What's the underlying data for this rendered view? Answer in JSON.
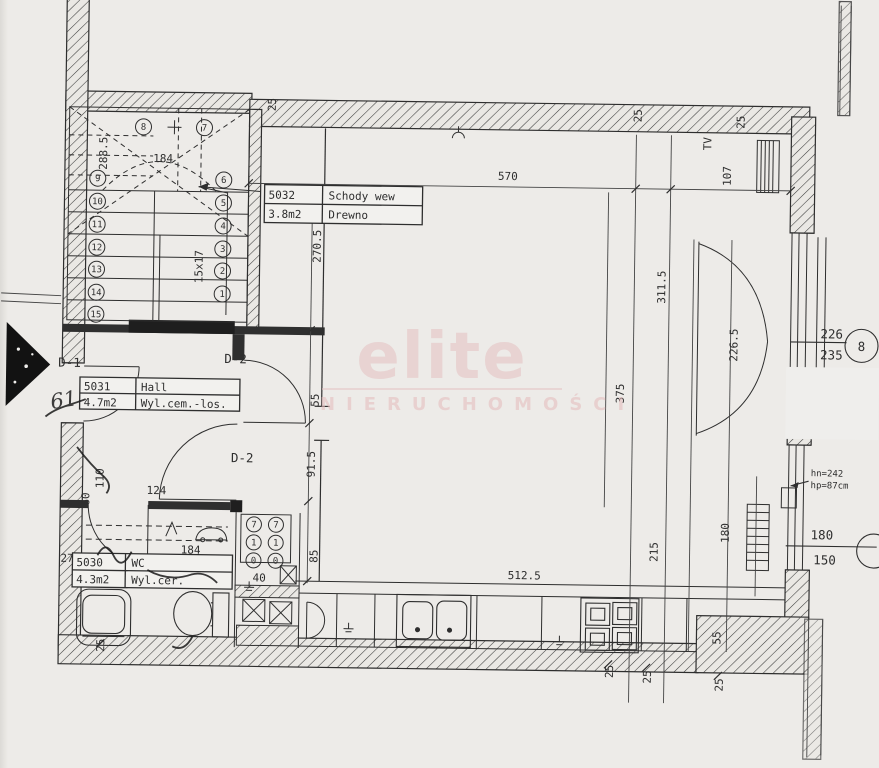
{
  "watermark": {
    "brand": "elite",
    "subtitle": "NIERUCHOMOŚCI"
  },
  "rooms": [
    {
      "id": "5032",
      "name": "Schody wew",
      "area": "3.8m2",
      "finish": "Drewno"
    },
    {
      "id": "5031",
      "name": "Hall",
      "area": "4.7m2",
      "finish": "Wyl.cem.-los."
    },
    {
      "id": "5030",
      "name": "WC",
      "area": "4.3m2",
      "finish": "Wyl.cer."
    }
  ],
  "doors": {
    "d1": "D-1",
    "d2_upper": "D-2",
    "d2_lower": "D-2"
  },
  "windows": {
    "balcony": {
      "w": "226",
      "h": "235",
      "num": "8"
    },
    "kitchen": {
      "w": "180",
      "h": "150",
      "note_top": "hn=242",
      "note_bottom": "hp=87cm"
    }
  },
  "stairs": {
    "steps": [
      "1",
      "2",
      "3",
      "4",
      "5",
      "6",
      "7",
      "8",
      "9",
      "10",
      "11",
      "12",
      "13",
      "14",
      "15"
    ],
    "note": "15x17"
  },
  "shaft": {
    "meters": [
      "7",
      "7",
      "1",
      "1",
      "0",
      "0"
    ]
  },
  "annotations": {
    "tv": "TV",
    "handwritten": "61"
  },
  "dims": {
    "top_left_25": "25",
    "top_mid_25": "25",
    "top_right_25": "25",
    "width_570": "570",
    "right_107": "107",
    "stair_288": "288.5",
    "stair_184": "184",
    "left_270": "270.5",
    "left_55": "55",
    "left_91": "91.5",
    "left_85": "85",
    "hall_110": "110",
    "hall_60": "60",
    "hall_124": "124",
    "wc_27": "27",
    "wc_184": "184",
    "shaft_40": "40",
    "counter_512": "512.5",
    "right_311": "311.5",
    "balcony_226": "226.5",
    "mid_375": "375",
    "kitchen_215": "215",
    "kitchen_180": "180",
    "stove_55": "55",
    "bl_25": "25",
    "b1_25": "25",
    "b2_25": "25",
    "b3_25": "25"
  }
}
